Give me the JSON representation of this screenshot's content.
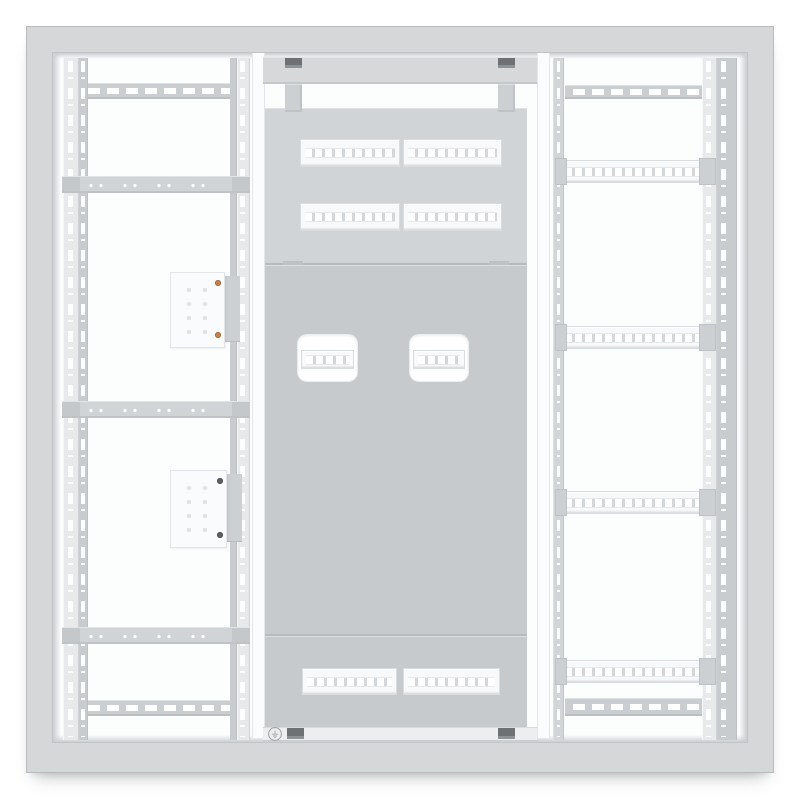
{
  "scene": {
    "object": "empty electrical distribution cabinet interior, front view render",
    "text_content": "none (image contains no readable text)",
    "symbols": [
      {
        "name": "earth-ground-symbol",
        "location": "bottom-left of center bay"
      }
    ]
  },
  "colors": {
    "background": "#ffffff",
    "frame": "#d5d7d9",
    "frame_edge": "#b9bcbe",
    "frame_inner_edge": "#c2c5c8",
    "interior": "#fcfdfd",
    "lip": "#cccfd2",
    "slotted_rail": "#cbced1",
    "strap": "#d1d4d6",
    "strap_tab": "#c5c8ca",
    "upright_face": "#e7e9eb",
    "upright_side": "#c9cccf",
    "upright_narrow": "#d3d6d8",
    "din": "#f7f9fa",
    "din_slot_gap": "#d4d7d9",
    "panel_upper": "#d1d4d6",
    "panel_main": "#c7cacd",
    "bottom_bar": "#eceef0",
    "notch": "#6e7174",
    "bracket": "#cdd0d3",
    "copper_screw": "#c5824d",
    "dark_screw": "#5f6366",
    "terminal_block": "#fafbfc",
    "hole_dot": "#e1e4e6",
    "symbol": "#a3a6a9"
  },
  "structure": {
    "uprights": [
      {
        "name": "left-bay-outer-upright",
        "x": 10,
        "y": 5,
        "w": 25,
        "h": 682,
        "parts": [
          {
            "kind": "face",
            "x": 0,
            "w": 16
          },
          {
            "kind": "side",
            "x": 16,
            "w": 9
          }
        ],
        "slots": [
          {
            "x": 5,
            "w": 5
          },
          {
            "x": 18,
            "w": 4
          }
        ]
      },
      {
        "name": "left-bay-inner-upright",
        "x": 177,
        "y": 5,
        "w": 20,
        "h": 682,
        "parts": [
          {
            "kind": "side",
            "x": 0,
            "w": 7
          },
          {
            "kind": "face",
            "x": 7,
            "w": 13
          }
        ],
        "slots": [
          {
            "x": 10,
            "w": 5
          }
        ]
      },
      {
        "name": "right-bay-inner-upright",
        "x": 500,
        "y": 5,
        "w": 11,
        "h": 682,
        "parts": [
          {
            "kind": "narrow",
            "x": 0,
            "w": 11
          }
        ],
        "slots": [
          {
            "x": 4,
            "w": 3
          }
        ]
      },
      {
        "name": "right-bay-outer-upright",
        "x": 649,
        "y": 5,
        "w": 35,
        "h": 682,
        "parts": [
          {
            "kind": "face",
            "x": 0,
            "w": 15
          },
          {
            "kind": "side",
            "x": 15,
            "w": 20
          }
        ],
        "slots": [
          {
            "x": 4,
            "w": 5
          },
          {
            "x": 19,
            "w": 5
          }
        ]
      }
    ],
    "rails": [
      {
        "name": "left-bay-top-slotted-rail",
        "type": "slotted",
        "x": 27,
        "y": 30,
        "w": 158,
        "h": 16
      },
      {
        "name": "left-bay-bottom-slotted-rail",
        "type": "slotted",
        "x": 27,
        "y": 647,
        "w": 158,
        "h": 16
      },
      {
        "name": "right-bay-top-slotted-rail",
        "type": "slotted",
        "x": 512,
        "y": 32,
        "w": 150,
        "h": 14
      },
      {
        "name": "right-bay-bottom-slotted-rail",
        "type": "slotted",
        "x": 512,
        "y": 645,
        "w": 152,
        "h": 18
      },
      {
        "name": "left-bay-cross-strap-1",
        "type": "strap",
        "x": 9,
        "y": 123,
        "w": 188,
        "h": 17
      },
      {
        "name": "left-bay-cross-strap-2",
        "type": "strap",
        "x": 9,
        "y": 348,
        "w": 188,
        "h": 17
      },
      {
        "name": "left-bay-cross-strap-3",
        "type": "strap",
        "x": 9,
        "y": 574,
        "w": 188,
        "h": 17
      },
      {
        "name": "right-bay-din-rail-1",
        "type": "din",
        "caps": true,
        "x": 507,
        "y": 107,
        "w": 143,
        "h": 21
      },
      {
        "name": "right-bay-din-rail-2",
        "type": "din",
        "caps": true,
        "x": 507,
        "y": 273,
        "w": 143,
        "h": 21
      },
      {
        "name": "right-bay-din-rail-3",
        "type": "din",
        "caps": true,
        "x": 507,
        "y": 438,
        "w": 143,
        "h": 21
      },
      {
        "name": "right-bay-din-rail-4",
        "type": "din",
        "caps": true,
        "x": 507,
        "y": 607,
        "w": 143,
        "h": 21
      },
      {
        "name": "center-din-row1-left",
        "type": "din",
        "x": 247,
        "y": 86,
        "w": 98,
        "h": 26
      },
      {
        "name": "center-din-row1-right",
        "type": "din",
        "x": 350,
        "y": 86,
        "w": 97,
        "h": 26
      },
      {
        "name": "center-din-row2-left",
        "type": "din",
        "x": 247,
        "y": 150,
        "w": 98,
        "h": 26
      },
      {
        "name": "center-din-row2-right",
        "type": "din",
        "x": 350,
        "y": 150,
        "w": 97,
        "h": 26
      },
      {
        "name": "center-din-bottom-left",
        "type": "din",
        "x": 249,
        "y": 615,
        "w": 93,
        "h": 25
      },
      {
        "name": "center-din-bottom-right",
        "type": "din",
        "x": 350,
        "y": 615,
        "w": 95,
        "h": 25
      }
    ],
    "cutouts": [
      {
        "name": "panel-cutout-left",
        "x": 245,
        "y": 282,
        "w": 59,
        "h": 46
      },
      {
        "name": "panel-cutout-right",
        "x": 357,
        "y": 282,
        "w": 58,
        "h": 46
      }
    ],
    "terminal_blocks": [
      {
        "name": "terminal-block-top",
        "x": 117,
        "y": 219,
        "w": 53,
        "h": 74,
        "plate": {
          "x": 165,
          "y": 223,
          "w": 22,
          "h": 66
        },
        "screw": "copper"
      },
      {
        "name": "terminal-block-bottom",
        "x": 117,
        "y": 417,
        "w": 55,
        "h": 76,
        "plate": {
          "x": 167,
          "y": 421,
          "w": 22,
          "h": 68
        },
        "screw": "dark"
      }
    ],
    "hangers": [
      {
        "x": 232,
        "y": 31
      },
      {
        "x": 445,
        "y": 31
      }
    ],
    "notches_top": [
      {
        "x": 232,
        "y": 5
      },
      {
        "x": 445,
        "y": 5
      }
    ],
    "notches_bottom": [
      {
        "x": 234,
        "y": 675
      },
      {
        "x": 445,
        "y": 675
      }
    ],
    "ground_symbol": {
      "x": 214,
      "y": 673
    }
  }
}
